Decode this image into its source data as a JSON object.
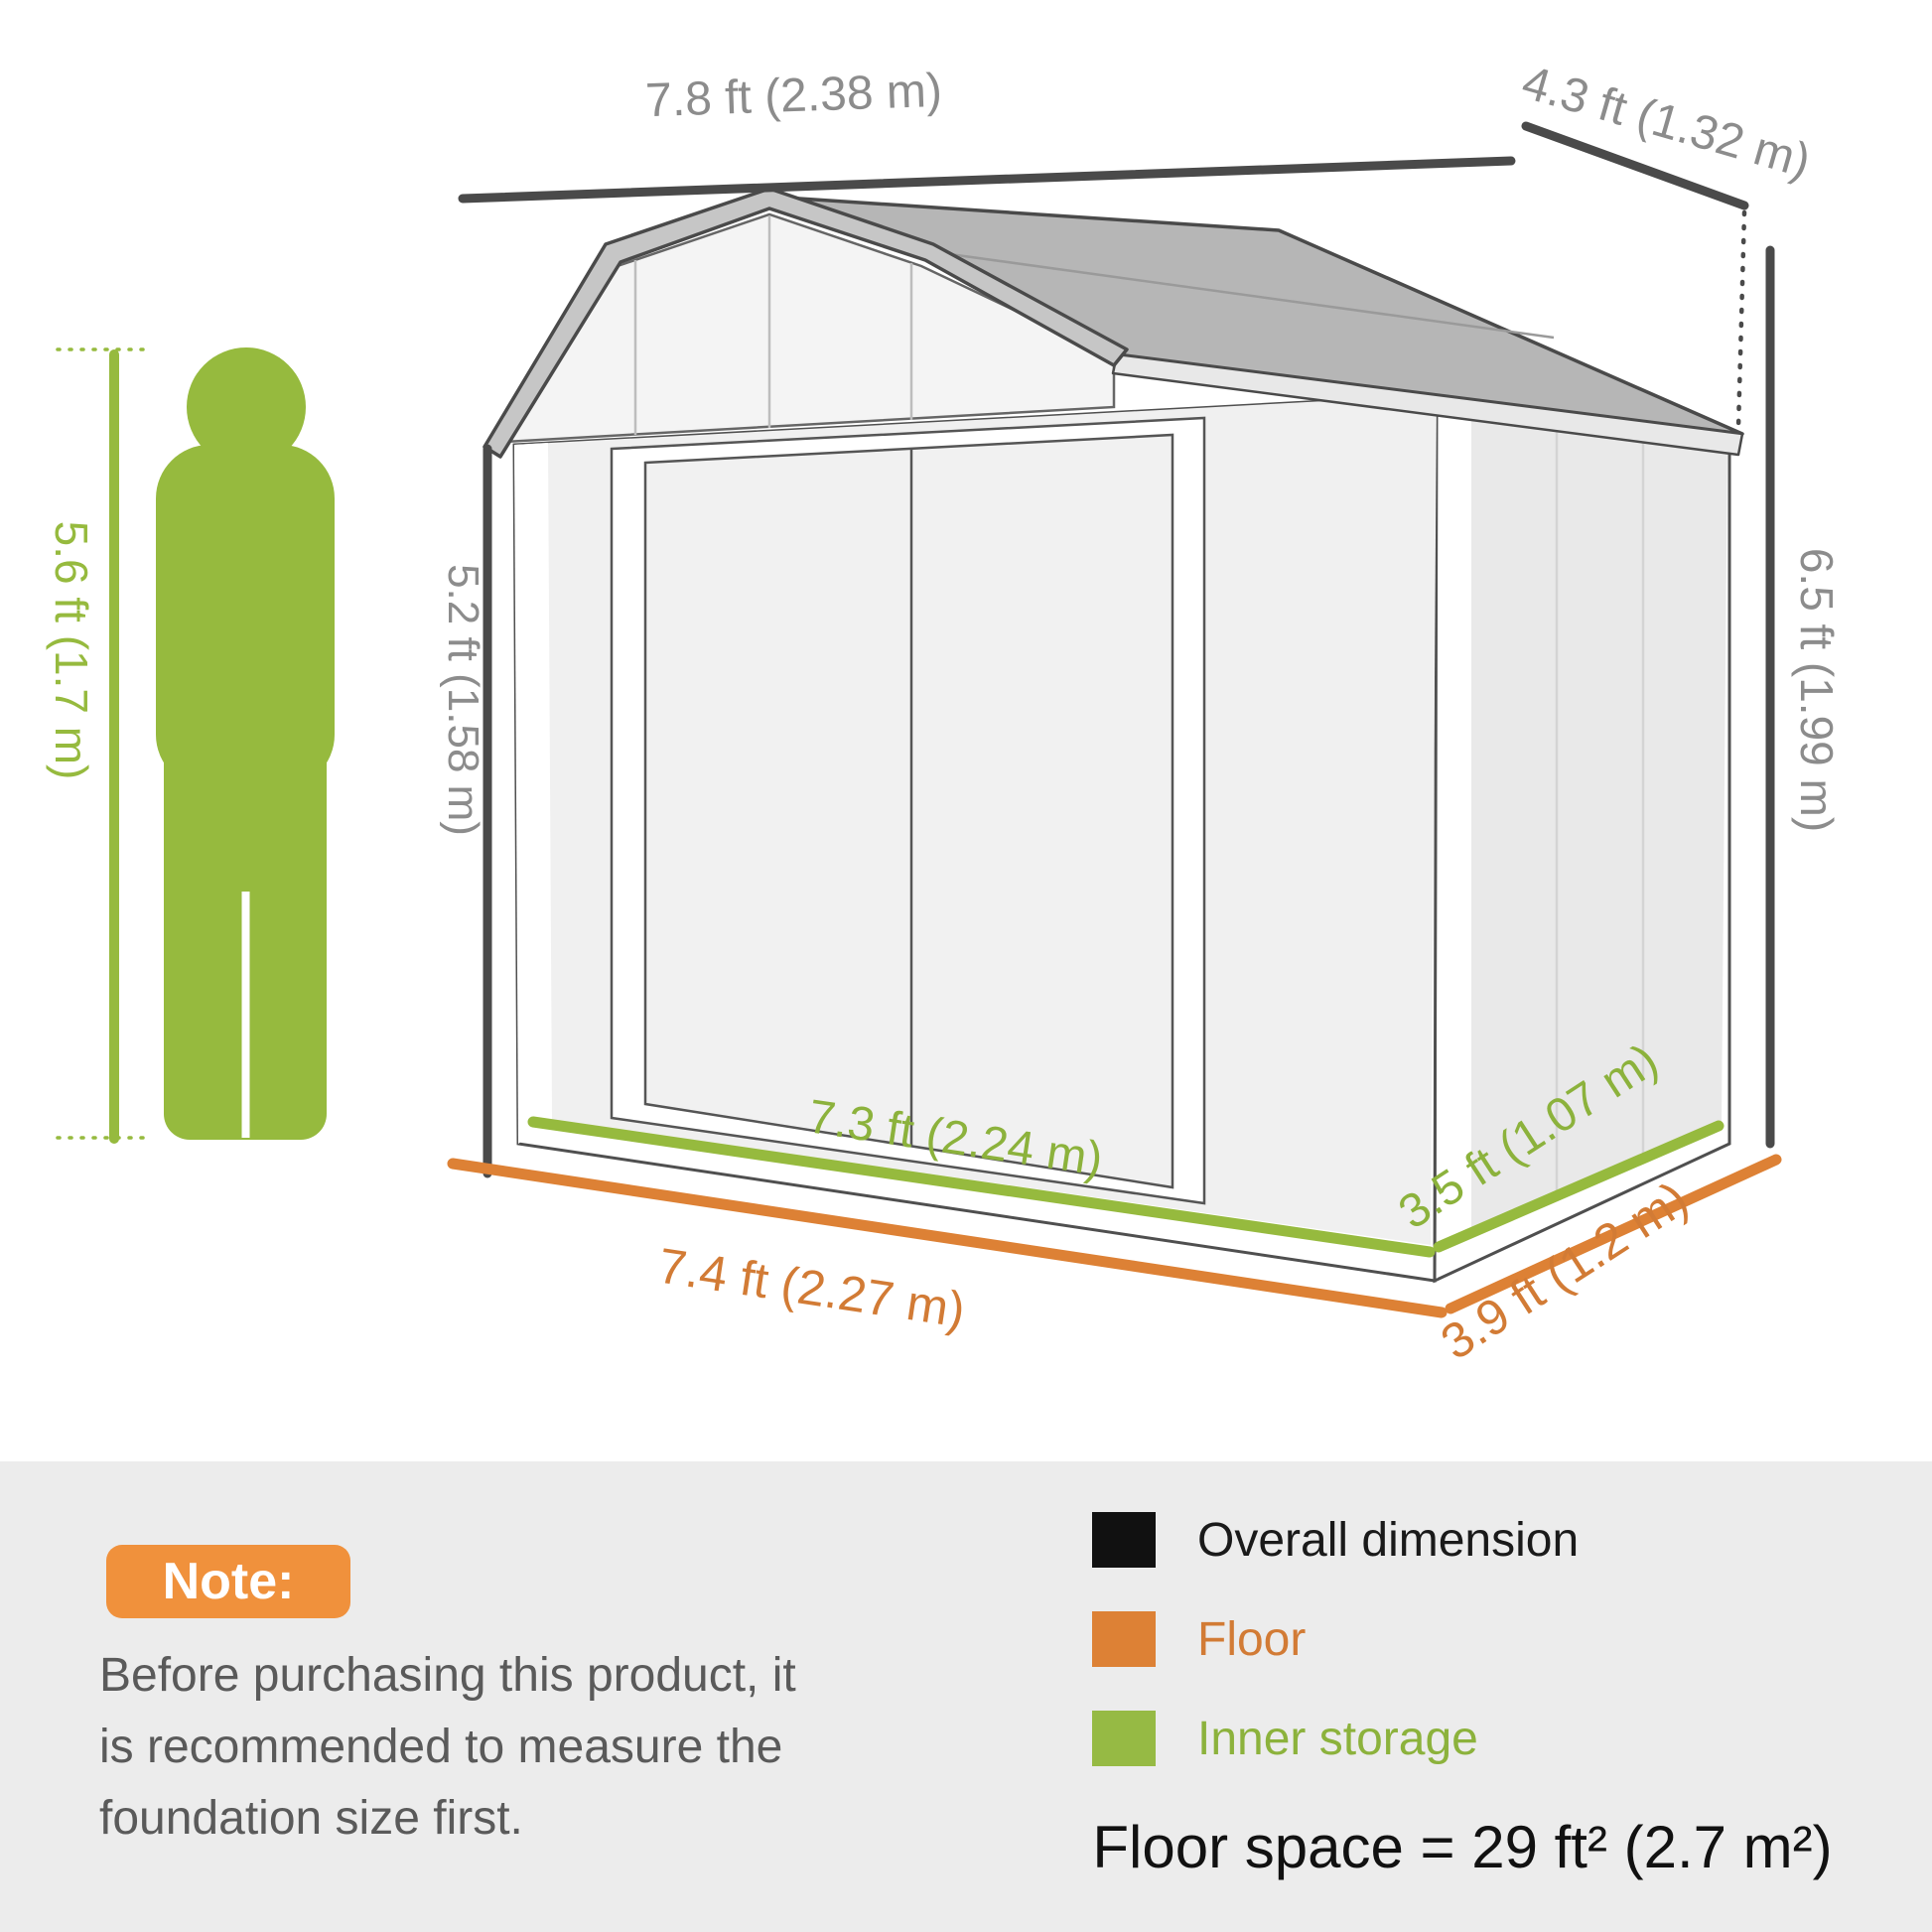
{
  "figure": {
    "person_height_label": "5.6 ft (1.7 m)",
    "dims": {
      "roof_width": "7.8 ft (2.38 m)",
      "roof_depth": "4.3 ft (1.32 m)",
      "eave_height": "5.2 ft (1.58 m)",
      "total_height": "6.5 ft (1.99 m)",
      "inner_width": "7.3 ft (2.24 m)",
      "floor_width": "7.4 ft (2.27 m)",
      "inner_depth": "3.5 ft (1.07 m)",
      "floor_depth": "3.9 ft (1.2 m)"
    },
    "colors": {
      "overall_dimension_line": "#4a4a4a",
      "floor_line": "#dd8135",
      "inner_storage_line": "#96ba3e",
      "dimension_text": "#8c8c8c",
      "person_green": "#96ba3e",
      "note_box_orange": "#f0913c"
    }
  },
  "note": {
    "title": "Note:",
    "lines": [
      "Before purchasing this product, it",
      "is recommended to measure the",
      "foundation size first."
    ]
  },
  "legend": {
    "items": [
      {
        "label": "Overall dimension",
        "color": "#111111"
      },
      {
        "label": "Floor",
        "color": "#dd8135"
      },
      {
        "label": "Inner storage",
        "color": "#96ba44"
      }
    ],
    "floor_space": "Floor space = 29 ft² (2.7 m²)"
  }
}
